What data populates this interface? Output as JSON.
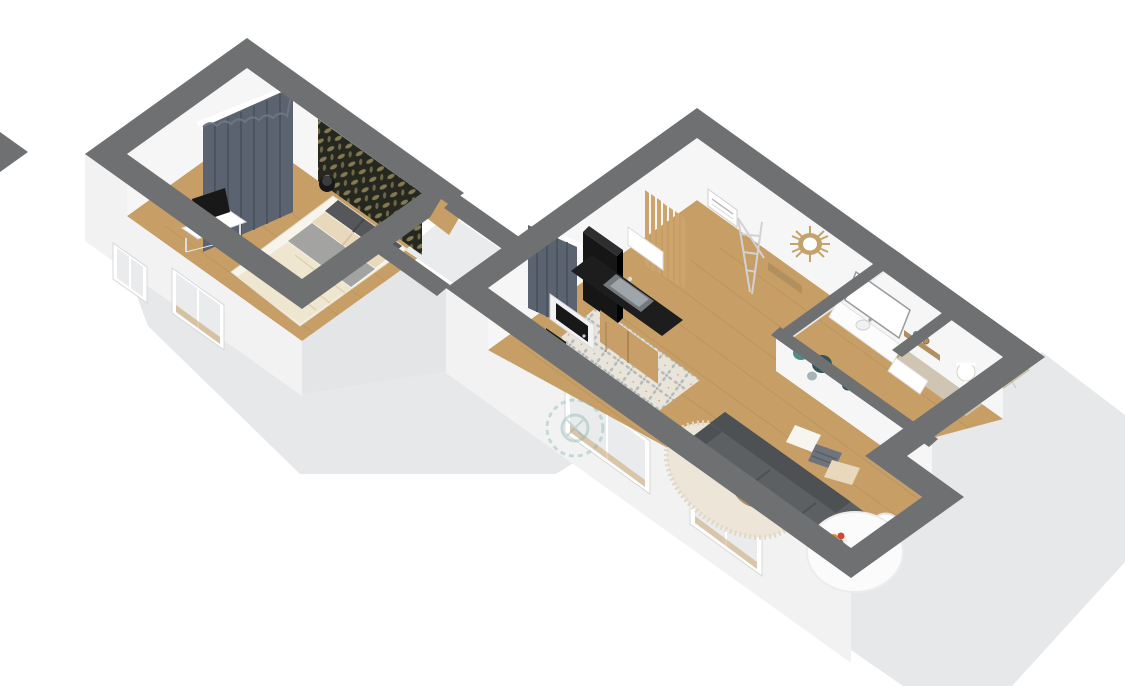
{
  "meta": {
    "title": "3D isometric floor plan — studio apartment",
    "view": "axonometric top-down 3d render",
    "has_text": false
  },
  "palette": {
    "bg": "#ffffff",
    "shadow": "#e7e8ea",
    "band": "#6e7072",
    "band_dark": "#646668",
    "ext_wall": "#f2f2f3",
    "ext_wall_shade": "#e4e5e7",
    "int_wall": "#f6f6f7",
    "int_wall_shade": "#eaebed",
    "wood": "#c79f66",
    "wood_dark": "#ad8750",
    "tile_base": "#e9e4d9",
    "tile_motif": "#a9b2b6",
    "tile_accent": "#c9937f",
    "shower_tile": "#cfc5b2",
    "shower_tile_dark": "#bfb49f",
    "curtain": "#5b6370",
    "curtain_dark": "#49505c",
    "wallpaper": "#26281f",
    "wallpaper_leaf": "#8d8259",
    "bed_duvet": "#efe6cf",
    "bed_blanket": "#a3a3a1",
    "bed_frame": "#f7f4ec",
    "pillow_beige": "#e8d9bc",
    "headboard": "#55575b",
    "tv_black": "#181818",
    "fridge": "#161616",
    "counter": "#1d1d1e",
    "cabinet": "#c89f68",
    "sink": "#9fa6ab",
    "sink_dark": "#73797e",
    "microwave": "#f2f2f2",
    "slat_wood": "#cda56c",
    "mirror_rattan": "#c3a36b",
    "sofa": "#5c6063",
    "sofa_dark": "#4d5154",
    "pillow_white": "#f7f5f0",
    "pillow_stripe": "#6f747c",
    "rug": "#ede6d8",
    "table_wood": "#b99b6d",
    "dining_white": "#fbfbfb",
    "plate_teal": "#4e8d8a",
    "plate_dark": "#33535c",
    "vanity_white": "#fcfcfd",
    "shelf_wood": "#b28f5e",
    "flower_orange": "#e8912b",
    "flower_red": "#cc4b33",
    "leaf_green": "#3f7d3a",
    "watermark": "#7fb2a8"
  },
  "rooms": {
    "bedroom": {
      "name": "bedroom",
      "floor": "wood",
      "items": [
        "window-curtain",
        "accent-wallpaper-wall",
        "double-bed",
        "headboard-cushions",
        "bedside-lamp",
        "desk-with-tv"
      ]
    },
    "hallway": {
      "name": "hallway",
      "floor": "light",
      "items": [
        "door"
      ]
    },
    "kitchen": {
      "name": "kitchen",
      "floor": "patterned-tile",
      "items": [
        "window-curtain",
        "tall-fridge",
        "counter-with-sink",
        "wood-cabinets",
        "upper-cabinet",
        "microwave",
        "bin",
        "slat-partition"
      ]
    },
    "living_room": {
      "name": "living-room",
      "floor": "wood",
      "items": [
        "sofa",
        "cushions",
        "coffee-tables",
        "shag-rug",
        "wall-plates",
        "sunburst-mirror",
        "drying-rack",
        "console",
        "electrical-panel"
      ]
    },
    "dining_nook": {
      "name": "dining-nook",
      "floor": "wood",
      "items": [
        "round-table",
        "chair",
        "fruit-bowl",
        "sunflower-vase"
      ]
    },
    "bathroom": {
      "name": "bathroom",
      "floor": "white",
      "items": [
        "vanity-mirror",
        "sink-counter",
        "wood-shelf",
        "low-cabinet"
      ]
    },
    "shower": {
      "name": "shower-room",
      "floor": "beige-tile",
      "items": [
        "shower-fixture"
      ]
    }
  }
}
